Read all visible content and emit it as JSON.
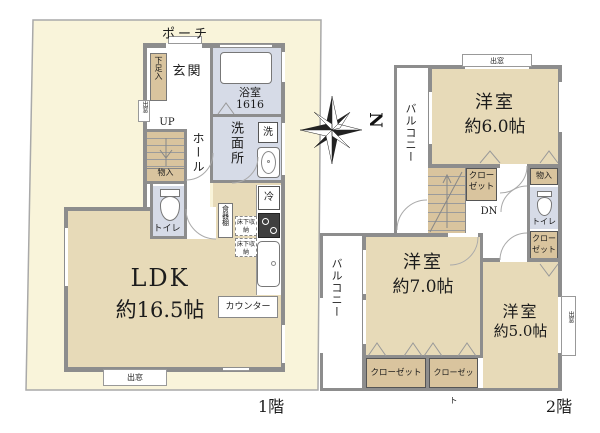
{
  "colors": {
    "lot": "#f9f4da",
    "room_tan": "#e7dab8",
    "closet_tan": "#d9c49e",
    "wet_blue": "#d6dbe7",
    "wall_gray": "#8d8d8d"
  },
  "compass": {
    "north": "N"
  },
  "floor1": {
    "label": "1階",
    "porch": "ポーチ",
    "entrance": "玄関",
    "shoe_storage": "下足入",
    "bath": "浴室",
    "bath_size": "1616",
    "washroom": "洗面所",
    "washer": "洗",
    "up": "UP",
    "stair_storage": "物入",
    "hall": "ホール",
    "toilet": "トイレ",
    "fridge": "冷",
    "cupboard": "食器棚",
    "floor_storage1": "床下収納",
    "floor_storage2": "床下収納",
    "ldk_name": "LDK",
    "ldk_size": "約16.5帖",
    "counter": "カウンター",
    "bay_left": "出窓",
    "bay_bottom": "出窓"
  },
  "floor2": {
    "label": "2階",
    "bay_top": "出窓",
    "room6_name": "洋室",
    "room6_size": "約6.0帖",
    "balcony_upper": "バルコニー",
    "closet_mid": "クローゼット",
    "storage": "物入",
    "toilet": "トイレ",
    "dn": "DN",
    "closet_right": "クローゼット",
    "balcony_lower": "バルコニー",
    "room7_name": "洋室",
    "room7_size": "約7.0帖",
    "room5_name": "洋室",
    "room5_size": "約5.0帖",
    "closet_bl": "クローゼット",
    "closet_br": "クローゼット",
    "bay_right": "出窓"
  }
}
